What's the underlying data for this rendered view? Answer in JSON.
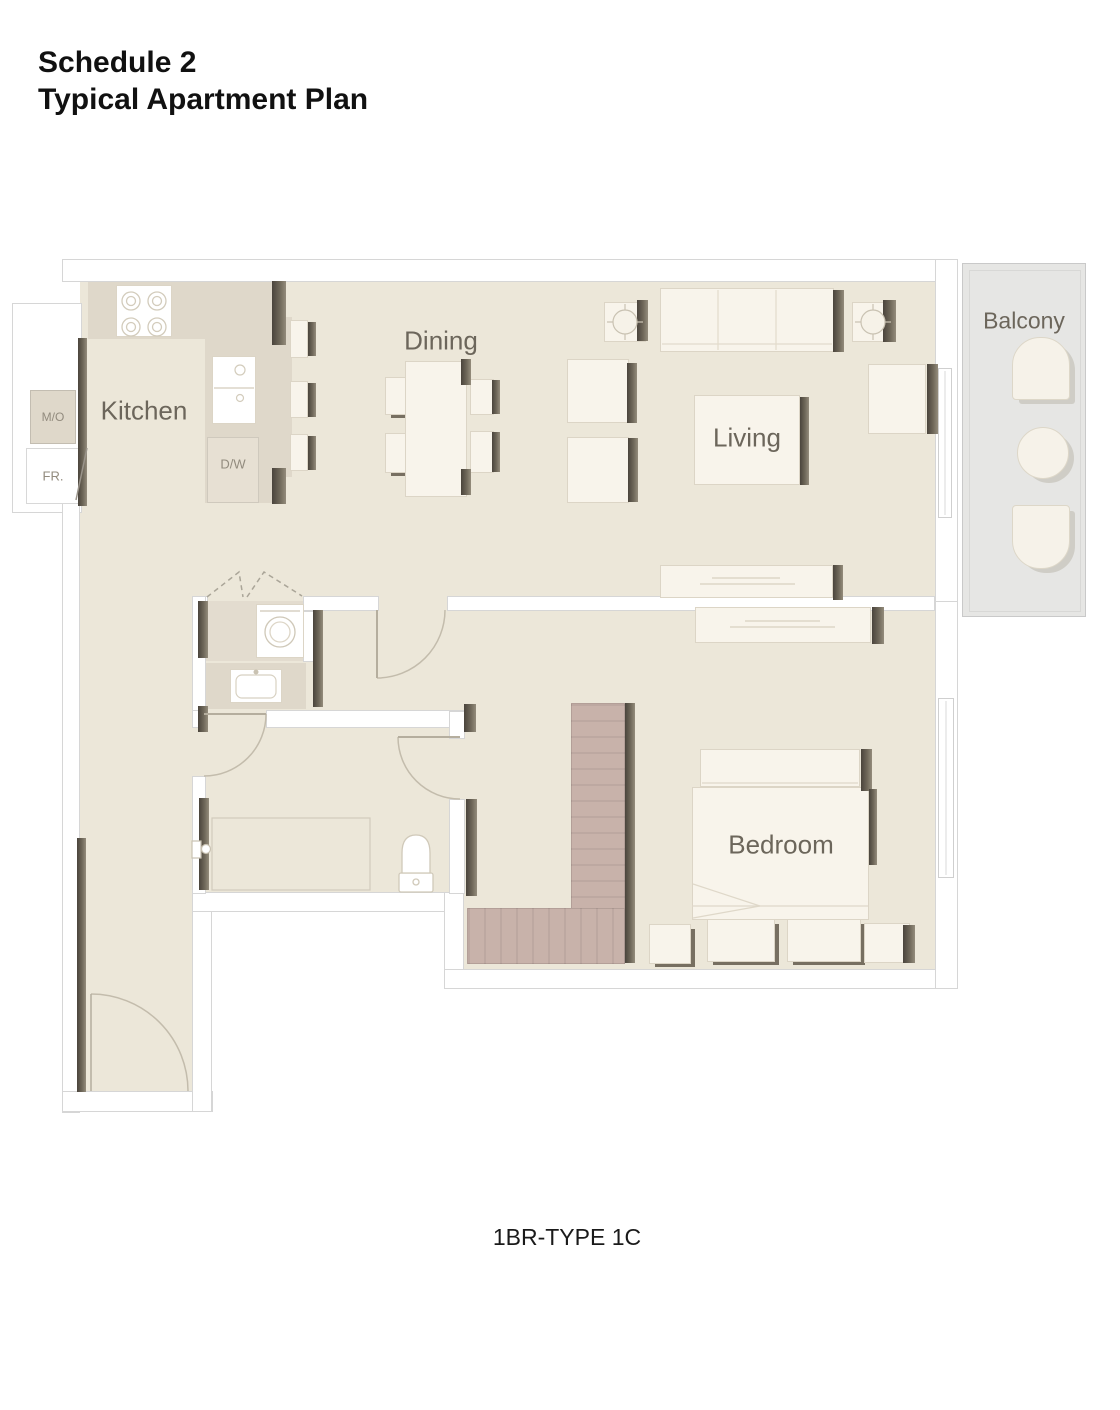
{
  "title": {
    "line1": "Schedule 2",
    "line2": "Typical Apartment Plan"
  },
  "caption": "1BR-TYPE 1C",
  "rooms": {
    "kitchen": "Kitchen",
    "dining": "Dining",
    "living": "Living",
    "bedroom": "Bedroom",
    "balcony": "Balcony"
  },
  "appliances": {
    "microwave_oven": "M/O",
    "fridge": "FR.",
    "dishwasher": "D/W"
  },
  "colors": {
    "floor": "#ECE7D9",
    "counter": "#DFD8CA",
    "wall_outline": "#D6D6D6",
    "wall_dark": "#57514A",
    "wardrobe": "#C8B2AA",
    "balcony": "#E6E6E4",
    "furniture": "#F8F4EB",
    "title_text": "#111111",
    "label_text": "#6C665B"
  }
}
